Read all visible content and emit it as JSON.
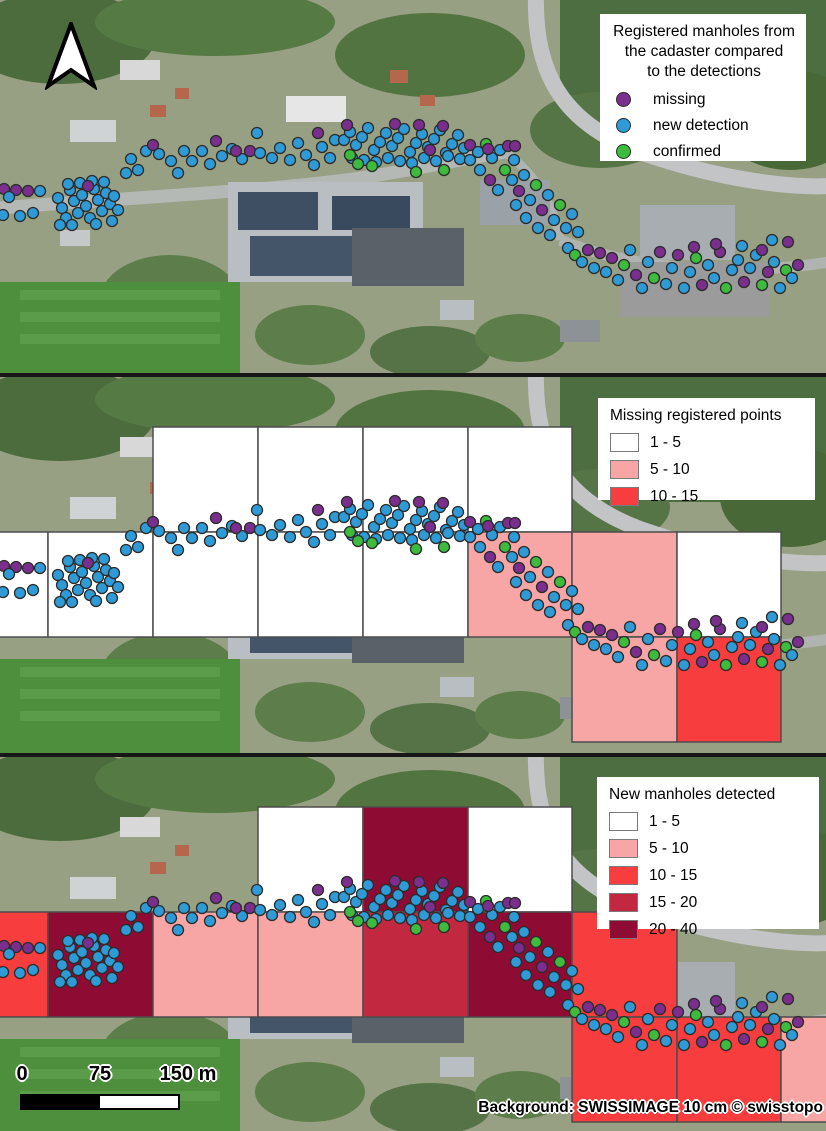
{
  "point_colors": {
    "m": "#7b2e8e",
    "n": "#2e9bd6",
    "c": "#3dbb3d"
  },
  "cell_colors": {
    "c1": "#ffffff",
    "c2": "#f8a5a5",
    "c3": "#f73d3d",
    "c4": "#c22840",
    "c5": "#8e0c34"
  },
  "panel1": {
    "legend": {
      "title_lines": [
        "Registered manholes from",
        "the cadaster compared",
        "to the detections"
      ],
      "items": [
        "missing",
        "new detection",
        "confirmed"
      ]
    }
  },
  "panel2": {
    "legend": {
      "title": "Missing registered points",
      "items": [
        {
          "range": "1 - 5",
          "color": "c1"
        },
        {
          "range": "5 - 10",
          "color": "c2"
        },
        {
          "range": "10 - 15",
          "color": "c3"
        }
      ]
    },
    "cells": [
      [
        153,
        50,
        105,
        105,
        "c1"
      ],
      [
        258,
        50,
        105,
        105,
        "c1"
      ],
      [
        363,
        50,
        105,
        105,
        "c1"
      ],
      [
        468,
        50,
        104,
        105,
        "c1"
      ],
      [
        -57,
        155,
        105,
        105,
        "c1"
      ],
      [
        48,
        155,
        105,
        105,
        "c1"
      ],
      [
        153,
        155,
        105,
        105,
        "c1"
      ],
      [
        258,
        155,
        105,
        105,
        "c1"
      ],
      [
        363,
        155,
        105,
        105,
        "c1"
      ],
      [
        468,
        155,
        104,
        105,
        "c2"
      ],
      [
        572,
        155,
        105,
        105,
        "c2"
      ],
      [
        677,
        155,
        104,
        105,
        "c1"
      ],
      [
        572,
        260,
        105,
        105,
        "c2"
      ],
      [
        677,
        260,
        104,
        105,
        "c3"
      ]
    ]
  },
  "panel3": {
    "legend": {
      "title": "New manholes detected",
      "items": [
        {
          "range": "1 - 5",
          "color": "c1"
        },
        {
          "range": "5 - 10",
          "color": "c2"
        },
        {
          "range": "10 - 15",
          "color": "c3"
        },
        {
          "range": "15 - 20",
          "color": "c4"
        },
        {
          "range": "20 - 40",
          "color": "c5"
        }
      ]
    },
    "cells": [
      [
        258,
        50,
        105,
        105,
        "c1"
      ],
      [
        363,
        50,
        105,
        105,
        "c5"
      ],
      [
        468,
        50,
        104,
        105,
        "c1"
      ],
      [
        -57,
        155,
        105,
        105,
        "c3"
      ],
      [
        48,
        155,
        105,
        105,
        "c5"
      ],
      [
        153,
        155,
        105,
        105,
        "c2"
      ],
      [
        258,
        155,
        105,
        105,
        "c2"
      ],
      [
        363,
        155,
        105,
        105,
        "c4"
      ],
      [
        468,
        155,
        104,
        105,
        "c5"
      ],
      [
        572,
        155,
        105,
        105,
        "c3"
      ],
      [
        572,
        260,
        105,
        105,
        "c3"
      ],
      [
        677,
        260,
        104,
        105,
        "c3"
      ],
      [
        781,
        260,
        105,
        105,
        "c2"
      ]
    ]
  },
  "scalebar": {
    "labels": [
      "0",
      "75",
      "150 m"
    ]
  },
  "attribution": "Background: SWISSIMAGE 10 cm © swisstopo",
  "points": [
    [
      4,
      189,
      "m"
    ],
    [
      16,
      190,
      "m"
    ],
    [
      28,
      191,
      "m"
    ],
    [
      40,
      191,
      "n"
    ],
    [
      9,
      197,
      "n"
    ],
    [
      3,
      215,
      "n"
    ],
    [
      20,
      216,
      "n"
    ],
    [
      33,
      213,
      "n"
    ],
    [
      58,
      198,
      "n"
    ],
    [
      62,
      208,
      "n"
    ],
    [
      66,
      218,
      "n"
    ],
    [
      70,
      190,
      "n"
    ],
    [
      74,
      201,
      "n"
    ],
    [
      78,
      213,
      "n"
    ],
    [
      82,
      195,
      "n"
    ],
    [
      86,
      206,
      "n"
    ],
    [
      90,
      218,
      "n"
    ],
    [
      94,
      189,
      "n"
    ],
    [
      98,
      200,
      "n"
    ],
    [
      102,
      211,
      "n"
    ],
    [
      106,
      193,
      "n"
    ],
    [
      110,
      204,
      "n"
    ],
    [
      68,
      184,
      "n"
    ],
    [
      80,
      183,
      "n"
    ],
    [
      92,
      181,
      "n"
    ],
    [
      104,
      182,
      "n"
    ],
    [
      114,
      196,
      "n"
    ],
    [
      60,
      225,
      "n"
    ],
    [
      72,
      225,
      "n"
    ],
    [
      96,
      224,
      "n"
    ],
    [
      112,
      221,
      "n"
    ],
    [
      118,
      210,
      "n"
    ],
    [
      88,
      186,
      "m"
    ],
    [
      126,
      173,
      "n"
    ],
    [
      138,
      170,
      "n"
    ],
    [
      131,
      159,
      "n"
    ],
    [
      146,
      151,
      "n"
    ],
    [
      159,
      154,
      "n"
    ],
    [
      153,
      145,
      "m"
    ],
    [
      171,
      161,
      "n"
    ],
    [
      178,
      173,
      "n"
    ],
    [
      184,
      151,
      "n"
    ],
    [
      192,
      161,
      "n"
    ],
    [
      202,
      151,
      "n"
    ],
    [
      210,
      164,
      "n"
    ],
    [
      216,
      141,
      "m"
    ],
    [
      222,
      156,
      "n"
    ],
    [
      232,
      149,
      "n"
    ],
    [
      242,
      159,
      "n"
    ],
    [
      236,
      151,
      "m"
    ],
    [
      250,
      151,
      "m"
    ],
    [
      260,
      153,
      "n"
    ],
    [
      257,
      133,
      "n"
    ],
    [
      272,
      158,
      "n"
    ],
    [
      280,
      148,
      "n"
    ],
    [
      290,
      160,
      "n"
    ],
    [
      298,
      143,
      "n"
    ],
    [
      306,
      155,
      "n"
    ],
    [
      314,
      165,
      "n"
    ],
    [
      322,
      147,
      "n"
    ],
    [
      330,
      158,
      "n"
    ],
    [
      318,
      133,
      "m"
    ],
    [
      335,
      140,
      "n"
    ],
    [
      344,
      140,
      "n"
    ],
    [
      350,
      132,
      "n"
    ],
    [
      356,
      145,
      "n"
    ],
    [
      362,
      137,
      "n"
    ],
    [
      368,
      128,
      "n"
    ],
    [
      374,
      150,
      "n"
    ],
    [
      380,
      142,
      "n"
    ],
    [
      386,
      133,
      "n"
    ],
    [
      392,
      146,
      "n"
    ],
    [
      398,
      138,
      "n"
    ],
    [
      404,
      129,
      "n"
    ],
    [
      410,
      152,
      "n"
    ],
    [
      416,
      143,
      "n"
    ],
    [
      422,
      134,
      "n"
    ],
    [
      428,
      147,
      "n"
    ],
    [
      434,
      139,
      "n"
    ],
    [
      440,
      130,
      "n"
    ],
    [
      446,
      153,
      "n"
    ],
    [
      452,
      144,
      "n"
    ],
    [
      458,
      135,
      "n"
    ],
    [
      464,
      148,
      "n"
    ],
    [
      352,
      158,
      "n"
    ],
    [
      364,
      160,
      "n"
    ],
    [
      376,
      162,
      "n"
    ],
    [
      388,
      158,
      "n"
    ],
    [
      400,
      161,
      "n"
    ],
    [
      412,
      163,
      "n"
    ],
    [
      424,
      158,
      "n"
    ],
    [
      436,
      161,
      "n"
    ],
    [
      448,
      156,
      "n"
    ],
    [
      460,
      159,
      "n"
    ],
    [
      347,
      125,
      "m"
    ],
    [
      395,
      124,
      "m"
    ],
    [
      443,
      126,
      "m"
    ],
    [
      430,
      150,
      "m"
    ],
    [
      419,
      125,
      "m"
    ],
    [
      358,
      164,
      "c"
    ],
    [
      372,
      166,
      "c"
    ],
    [
      416,
      172,
      "c"
    ],
    [
      444,
      170,
      "c"
    ],
    [
      350,
      155,
      "c"
    ],
    [
      470,
      145,
      "m"
    ],
    [
      478,
      152,
      "n"
    ],
    [
      486,
      144,
      "c"
    ],
    [
      492,
      158,
      "n"
    ],
    [
      500,
      150,
      "n"
    ],
    [
      508,
      146,
      "m"
    ],
    [
      514,
      160,
      "n"
    ],
    [
      488,
      149,
      "m"
    ],
    [
      515,
      146,
      "m"
    ],
    [
      505,
      170,
      "c"
    ],
    [
      512,
      180,
      "n"
    ],
    [
      519,
      191,
      "m"
    ],
    [
      524,
      175,
      "n"
    ],
    [
      530,
      200,
      "n"
    ],
    [
      536,
      185,
      "c"
    ],
    [
      542,
      210,
      "m"
    ],
    [
      548,
      195,
      "n"
    ],
    [
      554,
      220,
      "n"
    ],
    [
      560,
      205,
      "c"
    ],
    [
      566,
      228,
      "n"
    ],
    [
      572,
      214,
      "n"
    ],
    [
      578,
      232,
      "n"
    ],
    [
      470,
      160,
      "n"
    ],
    [
      480,
      170,
      "n"
    ],
    [
      490,
      180,
      "m"
    ],
    [
      498,
      190,
      "n"
    ],
    [
      516,
      205,
      "n"
    ],
    [
      526,
      218,
      "n"
    ],
    [
      538,
      228,
      "n"
    ],
    [
      550,
      235,
      "n"
    ],
    [
      568,
      248,
      "n"
    ],
    [
      575,
      255,
      "c"
    ],
    [
      582,
      262,
      "n"
    ],
    [
      588,
      250,
      "m"
    ],
    [
      594,
      268,
      "n"
    ],
    [
      600,
      253,
      "m"
    ],
    [
      606,
      272,
      "n"
    ],
    [
      612,
      258,
      "m"
    ],
    [
      618,
      280,
      "n"
    ],
    [
      624,
      265,
      "c"
    ],
    [
      630,
      250,
      "n"
    ],
    [
      636,
      275,
      "m"
    ],
    [
      642,
      288,
      "n"
    ],
    [
      648,
      262,
      "n"
    ],
    [
      654,
      278,
      "c"
    ],
    [
      660,
      252,
      "m"
    ],
    [
      666,
      284,
      "n"
    ],
    [
      672,
      268,
      "n"
    ],
    [
      678,
      255,
      "m"
    ],
    [
      684,
      288,
      "n"
    ],
    [
      690,
      272,
      "n"
    ],
    [
      696,
      258,
      "c"
    ],
    [
      702,
      285,
      "m"
    ],
    [
      708,
      265,
      "n"
    ],
    [
      714,
      278,
      "n"
    ],
    [
      720,
      252,
      "m"
    ],
    [
      726,
      288,
      "c"
    ],
    [
      732,
      270,
      "n"
    ],
    [
      738,
      260,
      "n"
    ],
    [
      744,
      282,
      "m"
    ],
    [
      750,
      268,
      "n"
    ],
    [
      756,
      255,
      "n"
    ],
    [
      762,
      285,
      "c"
    ],
    [
      768,
      272,
      "m"
    ],
    [
      774,
      262,
      "n"
    ],
    [
      780,
      288,
      "n"
    ],
    [
      786,
      270,
      "c"
    ],
    [
      792,
      278,
      "n"
    ],
    [
      798,
      265,
      "m"
    ],
    [
      694,
      247,
      "m"
    ],
    [
      716,
      244,
      "m"
    ],
    [
      742,
      246,
      "n"
    ],
    [
      762,
      250,
      "m"
    ],
    [
      788,
      242,
      "m"
    ],
    [
      772,
      240,
      "n"
    ]
  ]
}
